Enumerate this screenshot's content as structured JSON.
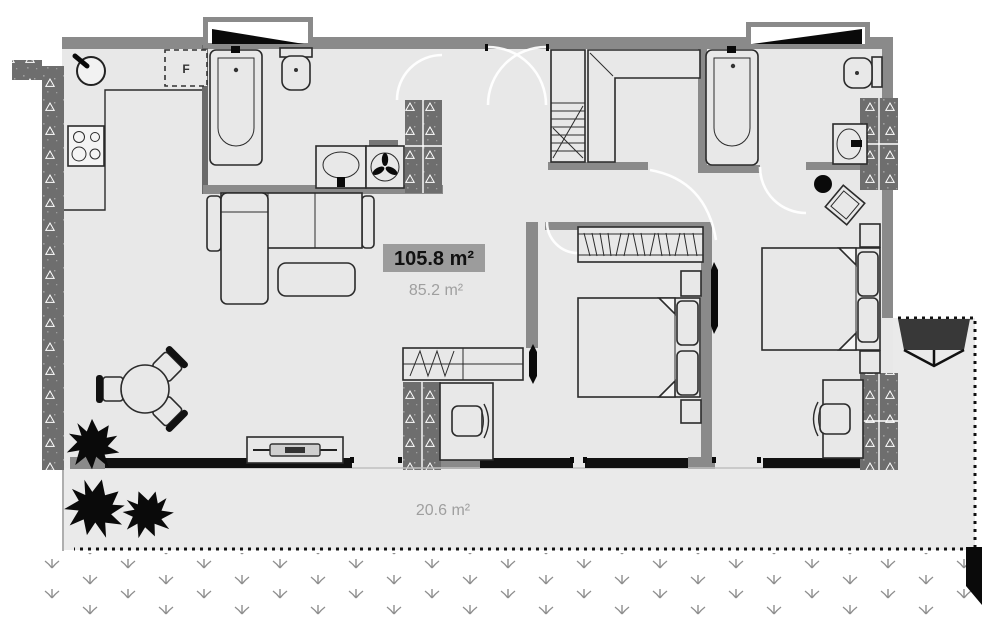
{
  "plan": {
    "type": "apartment-floor-plan",
    "area_labels": {
      "total": "105.8 m²",
      "interior": "85.2 m²",
      "terrace": "20.6 m²"
    },
    "appliance_labels": {
      "fridge": "F"
    },
    "colors": {
      "floor": "#e8e8e8",
      "wall_gray": "#8a8a8a",
      "hatched_wall": "#6e6e6e",
      "outline": "#2b2b2b",
      "glazing_black": "#000000",
      "label_highlight_bg": "#9c9c9c",
      "muted_text": "#9f9f9f",
      "awning_dark": "#383838"
    },
    "furniture": [
      "kitchen-sink",
      "stove",
      "fridge",
      "bathtub",
      "toilet",
      "washbasin",
      "washing-machine",
      "corner-sofa",
      "coffee-table",
      "dining-table",
      "dining-chair",
      "tv-sideboard",
      "plant",
      "wardrobe",
      "closet-shelves",
      "double-bed",
      "nightstand",
      "pillow",
      "desk",
      "desk-chair",
      "wall-tv",
      "stool",
      "side-table",
      "awning",
      "grass",
      "window",
      "terrace-boundary"
    ]
  }
}
